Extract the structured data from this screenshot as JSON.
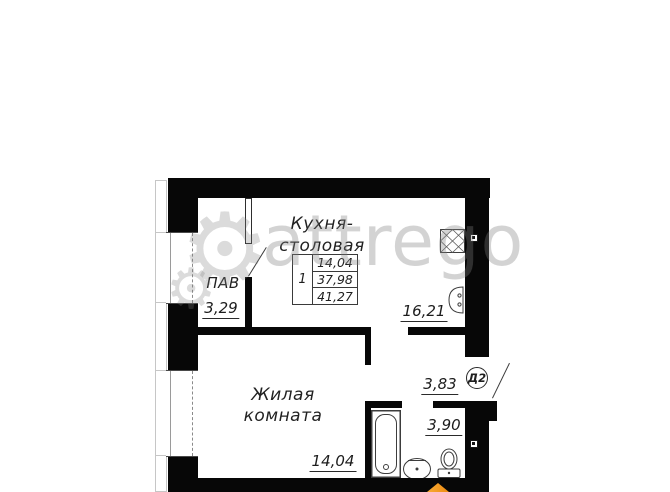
{
  "watermark": {
    "text": "attrego"
  },
  "icons": {
    "gear": "⚙"
  },
  "plan": {
    "rooms": {
      "kitchen": {
        "name_line1": "Кухня-",
        "name_line2": "столовая",
        "area": "16,21"
      },
      "pav": {
        "name": "ПАВ",
        "area": "3,29"
      },
      "living": {
        "name_line1": "Жилая",
        "name_line2": "комната",
        "area": "14,04"
      },
      "hallway": {
        "area": "3,83"
      },
      "bathroom": {
        "area": "3,90"
      }
    },
    "stamp": {
      "rooms_count": "1",
      "living_area": "14,04",
      "apartment_area": "37,98",
      "total_area": "41,27"
    },
    "entry_door_label": "Д2"
  },
  "colors": {
    "wall": "#070707",
    "orange_marker": "#ee8c12"
  }
}
